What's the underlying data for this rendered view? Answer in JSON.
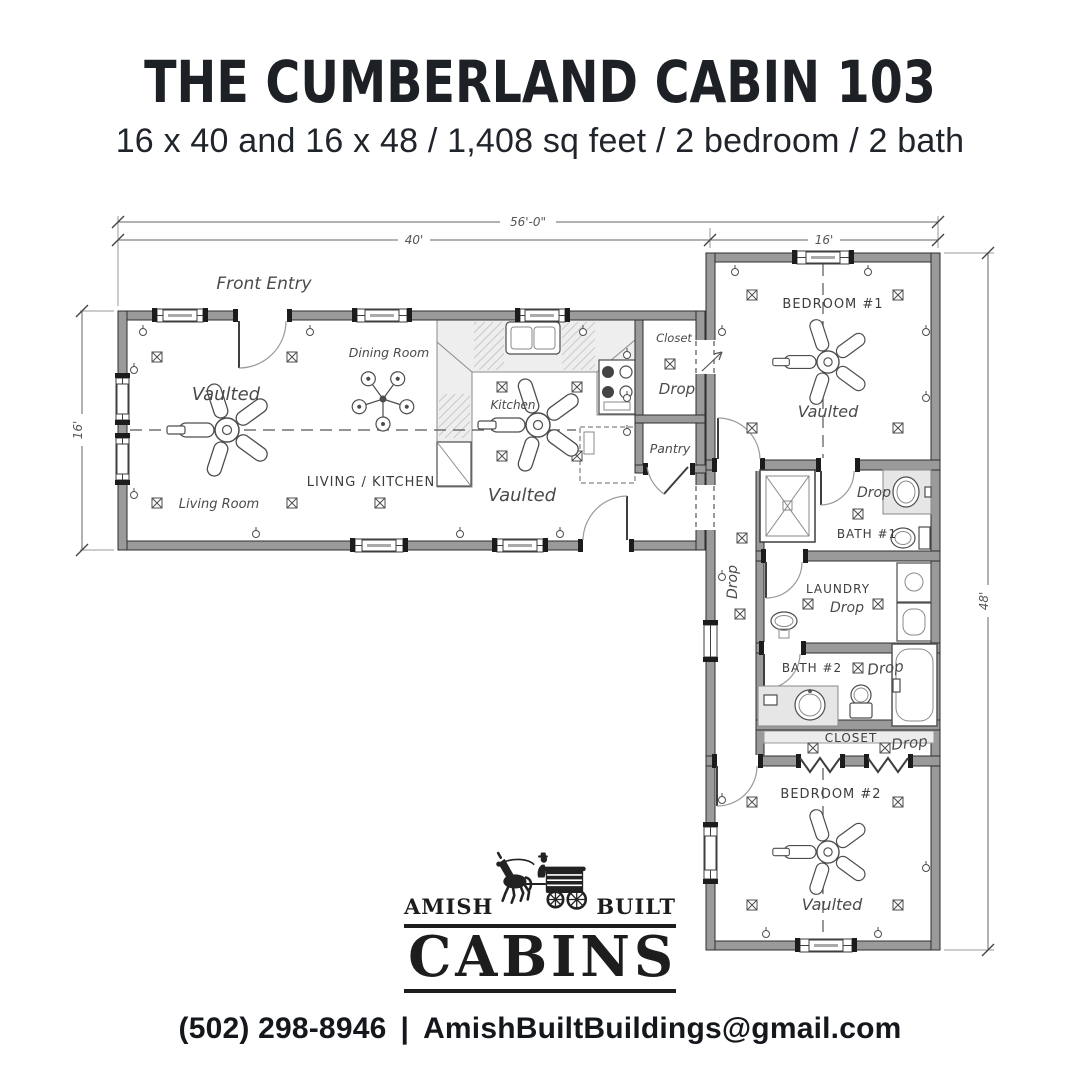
{
  "header": {
    "title": "THE CUMBERLAND CABIN 103",
    "subtitle": "16 x 40 and 16 x 48 / 1,408 sq feet / 2 bedroom / 2 bath"
  },
  "plan": {
    "dimensions": {
      "overall_width": "56'-0\"",
      "left_wing_width": "40'",
      "right_wing_width": "16'",
      "left_wing_depth": "16'",
      "right_wing_depth": "48'"
    },
    "labels": {
      "front_entry": "Front Entry",
      "dining_room": "Dining Room",
      "kitchen": "Kitchen",
      "living_room": "Living Room",
      "living_kitchen": "LIVING / KITCHEN",
      "vaulted": "Vaulted",
      "drop": "Drop",
      "closet": "Closet",
      "pantry": "Pantry",
      "bedroom_1": "BEDROOM #1",
      "bath_1": "BATH #1",
      "laundry": "LAUNDRY",
      "bath_2": "BATH #2",
      "closet_2": "CLOSET",
      "bedroom_2": "BEDROOM #2"
    }
  },
  "logo": {
    "amish": "AMISH",
    "built": "BUILT",
    "cabins": "CABINS"
  },
  "footer": {
    "phone": "(502) 298-8946",
    "separator": "|",
    "email": "AmishBuiltBuildings@gmail.com"
  },
  "colors": {
    "ink": "#1d2025",
    "linework": "#4a4a4a",
    "wall_fill": "#9a9a9a"
  }
}
